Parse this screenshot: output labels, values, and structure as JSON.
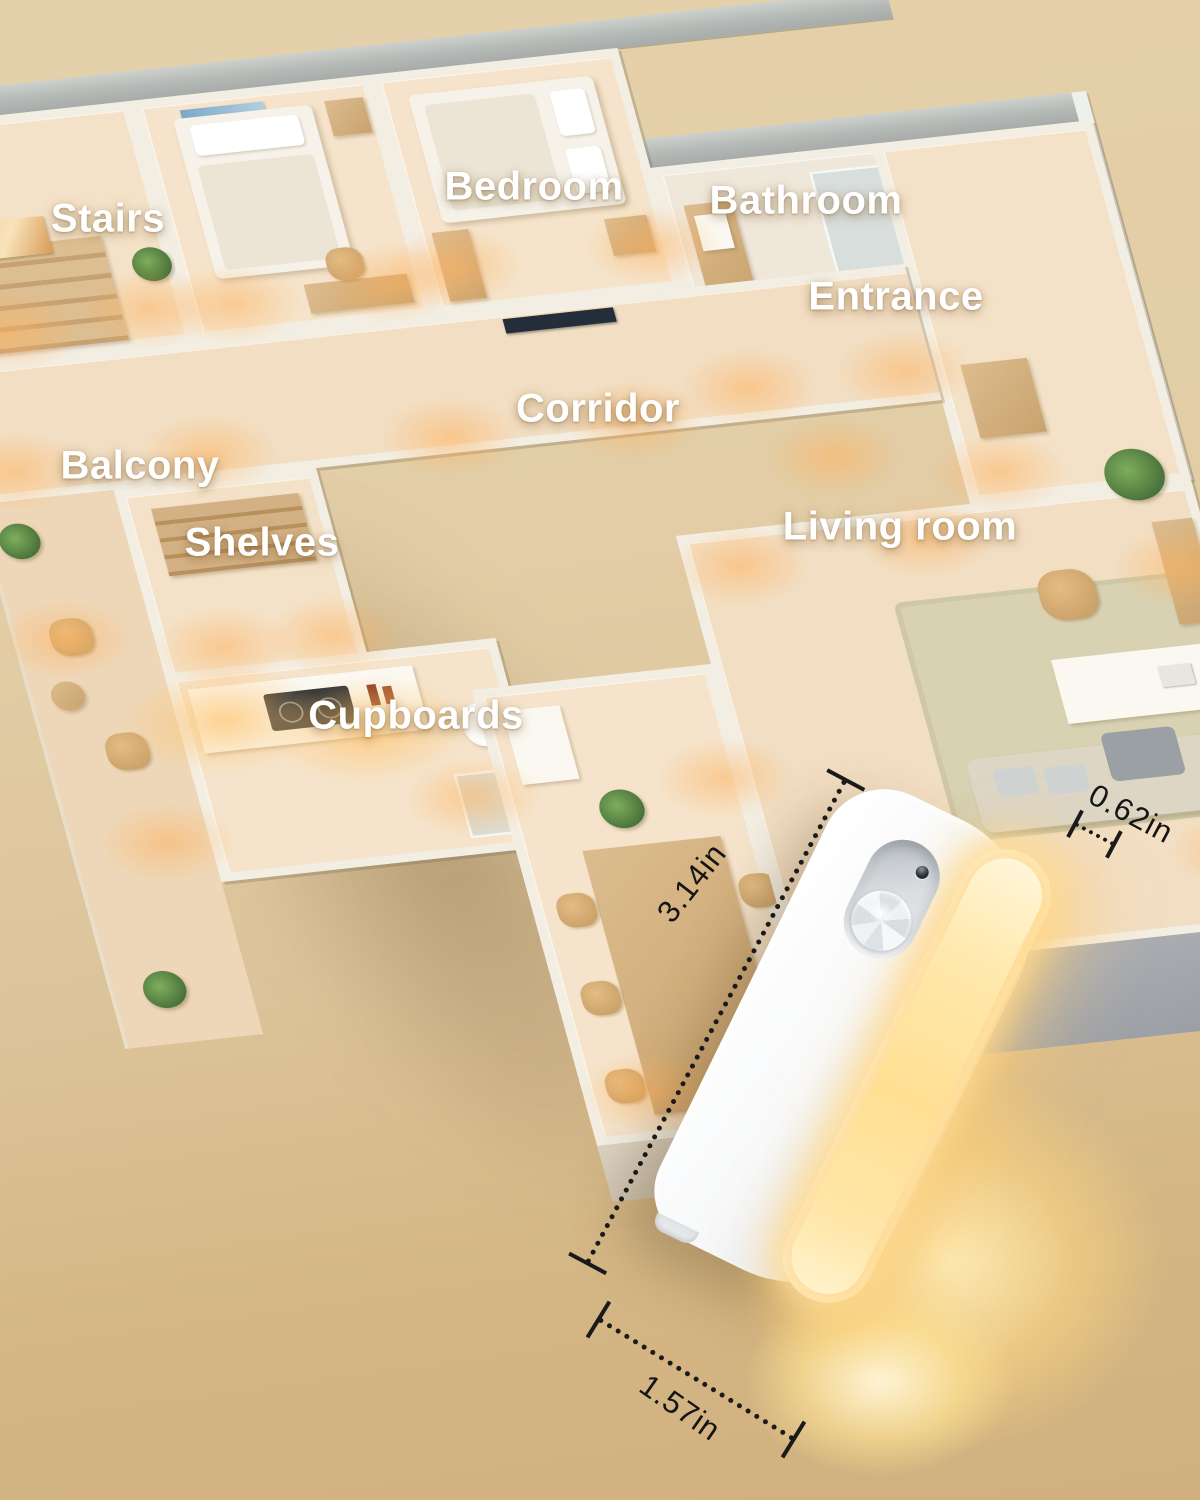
{
  "scene": {
    "type": "product-lifestyle-render",
    "background_top_color": "#e4d0aa",
    "background_bottom_color": "#d0b07e"
  },
  "floorplan": {
    "label_color": "#ffffff",
    "wall_color": "#f3eee3",
    "floor_color": "#f4e2c8",
    "accent_light_color": "#ffb15c",
    "labels": [
      {
        "id": "stairs",
        "text": "Stairs"
      },
      {
        "id": "bedroom",
        "text": "Bedroom"
      },
      {
        "id": "bathroom",
        "text": "Bathroom"
      },
      {
        "id": "entrance",
        "text": "Entrance"
      },
      {
        "id": "corridor",
        "text": "Corridor"
      },
      {
        "id": "balcony",
        "text": "Balcony"
      },
      {
        "id": "shelves",
        "text": "Shelves"
      },
      {
        "id": "living-room",
        "text": "Living room"
      },
      {
        "id": "cupboards",
        "text": "Cupboards"
      }
    ]
  },
  "product": {
    "name": "motion-sensor-night-light",
    "body_color": "#f4f6f7",
    "glow_color": "#ffe093",
    "dimensions": {
      "height": "3.14in",
      "thickness": "0.62in",
      "width": "1.57in"
    }
  }
}
